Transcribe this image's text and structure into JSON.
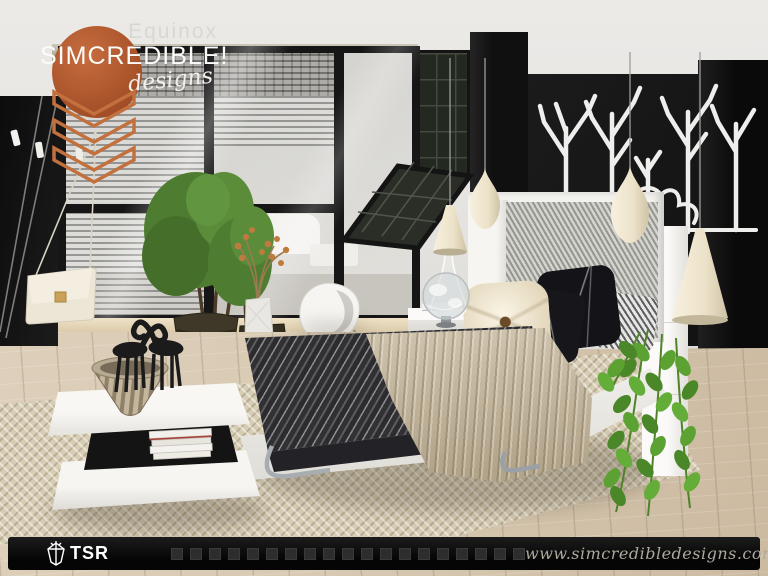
{
  "branding": {
    "title": "Equinox",
    "studio": "SIMCREDIBLE!",
    "sub": "designs"
  },
  "footer": {
    "logo_text": "TSR",
    "website": "www.simcredibledesigns.com"
  },
  "palette": {
    "accent_orange": "#bb5f33",
    "wall_black": "#131313",
    "wall_white": "#e9e8e5",
    "window_glass": "#d6d5d2",
    "floor_wood": "#d7c9b2",
    "rug_beige": "#d7cdb4",
    "bed_white": "#f3f2ef",
    "duvet_gray": "#39393c",
    "throw_beige": "#c9bba0",
    "lamp_cream": "#efe7d3",
    "plant_green": "#5b9335",
    "footer_bar": "#0c0c0c"
  },
  "scene_objects": [
    "black accent walls",
    "floor-to-ceiling window wall with blinds",
    "angled greenhouse window",
    "white tree-branch wall art",
    "upholstered herringbone headboard bed with striped duvet and knit throw",
    "cream pendant lamps",
    "glass globe decor",
    "hanging vine plant",
    "potted trees in wicker baskets",
    "white egg chair",
    "two-tier white coffee table with giraffe figurines, striped bowl and books",
    "hanging clutch bag",
    "herringbone area rug",
    "wood plank floor"
  ]
}
